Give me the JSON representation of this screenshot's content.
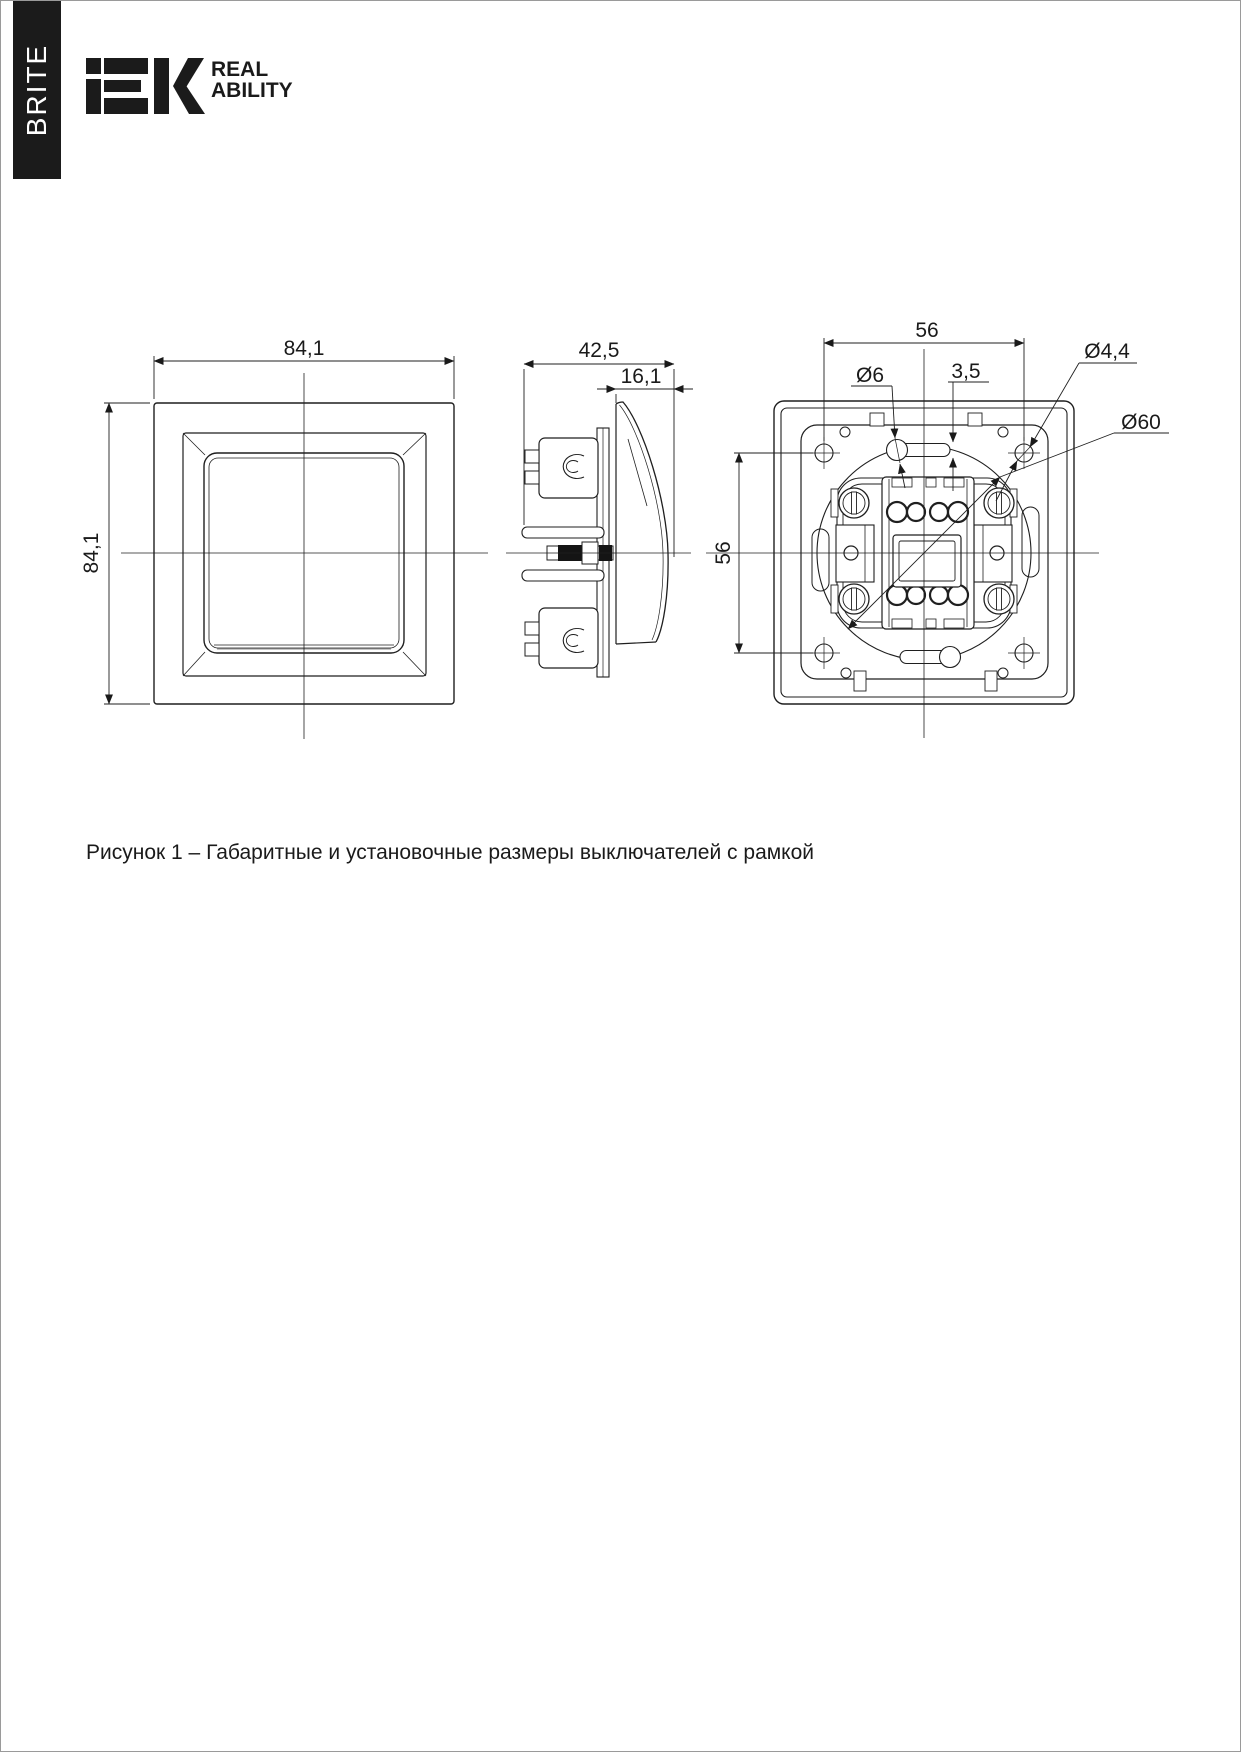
{
  "header": {
    "series_tab": "BRITE",
    "brand": "IEK",
    "tagline_line1": "REAL",
    "tagline_line2": "ABILITY"
  },
  "figure": {
    "caption": "Рисунок 1 – Габаритные и установочные размеры выключателей с рамкой"
  },
  "dims": {
    "front_w": "84,1",
    "front_h": "84,1",
    "depth": "42,5",
    "front_depth": "16,1",
    "hole_spacing_h": "56",
    "hole_spacing_v": "56",
    "keyhole_d": "Ø6",
    "slot_w": "3,5",
    "screw_hole_d": "Ø4,4",
    "mount_circle_d": "Ø60"
  }
}
